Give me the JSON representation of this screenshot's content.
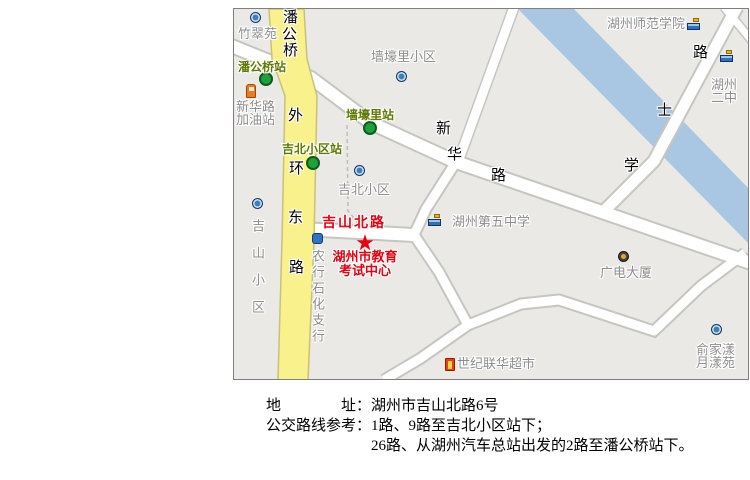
{
  "colors": {
    "block_gray": "#eae9e6",
    "road_white": "#ffffff",
    "road_casing": "#c6c6c1",
    "main_road_yellow": "#f8f18c",
    "river_blue": "#a9c6e2",
    "station_green_dot": "#1fa13a",
    "station_text_green": "#5e7a00",
    "poi_text_gray": "#8e8e8e",
    "highlight_red": "#e60012"
  },
  "map": {
    "stations": [
      {
        "label": "潘公桥站",
        "x": 238,
        "y": 61,
        "dot_x": 266,
        "dot_y": 79
      },
      {
        "label": "墙壕里站",
        "x": 346,
        "y": 109,
        "dot_x": 370,
        "dot_y": 128
      },
      {
        "label": "吉北小区站",
        "x": 282,
        "y": 143,
        "dot_x": 313,
        "dot_y": 163
      }
    ],
    "pois": [
      {
        "lines": [
          "竹翠苑"
        ],
        "x": 238,
        "y": 27,
        "icon": "residence",
        "icon_x": 250,
        "icon_y": 12
      },
      {
        "lines": [
          "新华路",
          "加油站"
        ],
        "x": 236,
        "y": 100,
        "icon": "gas",
        "icon_x": 246,
        "icon_y": 84
      },
      {
        "lines": [
          "墙壕里小区"
        ],
        "x": 371,
        "y": 50,
        "icon": "residence",
        "icon_x": 396,
        "icon_y": 71
      },
      {
        "lines": [
          "吉北小区"
        ],
        "x": 338,
        "y": 183,
        "icon": "residence",
        "icon_x": 354,
        "icon_y": 165
      },
      {
        "lines": [
          "吉山小区"
        ],
        "vertical": true,
        "spacing": 14,
        "x": 251,
        "y": 219,
        "icon": "residence",
        "icon_x": 252,
        "icon_y": 198
      },
      {
        "lines": [
          "农行石化支行"
        ],
        "vertical": true,
        "spacing": 3,
        "x": 311,
        "y": 249,
        "icon": "bank",
        "icon_x": 312,
        "icon_y": 233
      },
      {
        "lines": [
          "湖州第五中学"
        ],
        "x": 452,
        "y": 215,
        "icon": "school",
        "icon_x": 428,
        "icon_y": 214
      },
      {
        "lines": [
          "广电大厦"
        ],
        "x": 600,
        "y": 266,
        "icon": "tv",
        "icon_x": 618,
        "icon_y": 251
      },
      {
        "lines": [
          "世纪联华超市"
        ],
        "x": 457,
        "y": 357,
        "icon": "market",
        "icon_x": 445,
        "icon_y": 358
      },
      {
        "lines": [
          "俞家漾",
          "月漾苑"
        ],
        "x": 696,
        "y": 343,
        "icon": "residence",
        "icon_x": 711,
        "icon_y": 324
      },
      {
        "lines": [
          "湖州师范学院"
        ],
        "x": 607,
        "y": 17,
        "icon": "school",
        "icon_x": 687,
        "icon_y": 18
      },
      {
        "lines": [
          "湖州",
          "二中"
        ],
        "x": 711,
        "y": 78,
        "icon": "school",
        "icon_x": 720,
        "icon_y": 50
      }
    ],
    "road_chars": [
      {
        "t": "潘",
        "x": 283,
        "y": 10
      },
      {
        "t": "公",
        "x": 282,
        "y": 27
      },
      {
        "t": "桥",
        "x": 283,
        "y": 43
      },
      {
        "t": "外",
        "x": 288,
        "y": 108
      },
      {
        "t": "环",
        "x": 289,
        "y": 161
      },
      {
        "t": "东",
        "x": 288,
        "y": 210
      },
      {
        "t": "路",
        "x": 289,
        "y": 260
      },
      {
        "t": "新",
        "x": 436,
        "y": 121
      },
      {
        "t": "华",
        "x": 447,
        "y": 147
      },
      {
        "t": "路",
        "x": 491,
        "y": 168
      },
      {
        "t": "路",
        "x": 693,
        "y": 45
      },
      {
        "t": "士",
        "x": 657,
        "y": 103
      },
      {
        "t": "学",
        "x": 624,
        "y": 158
      }
    ],
    "red_road_label": {
      "text": "吉山北路",
      "x": 322,
      "y": 216
    },
    "destination": {
      "star": "★",
      "star_x": 365,
      "star_y": 243,
      "name_lines": [
        "湖州市教育",
        "考试中心"
      ],
      "x": 365,
      "y": 250
    }
  },
  "caption": {
    "rows": [
      {
        "label_parts": [
          "地",
          "址："
        ],
        "text": "湖州市吉山北路6号"
      },
      {
        "label_parts": [
          "公交路线参考："
        ],
        "text": "1路、9路至吉北小区站下；"
      },
      {
        "label_parts": [],
        "text": "26路、从湖州汽车总站出发的2路至潘公桥站下。"
      }
    ]
  }
}
